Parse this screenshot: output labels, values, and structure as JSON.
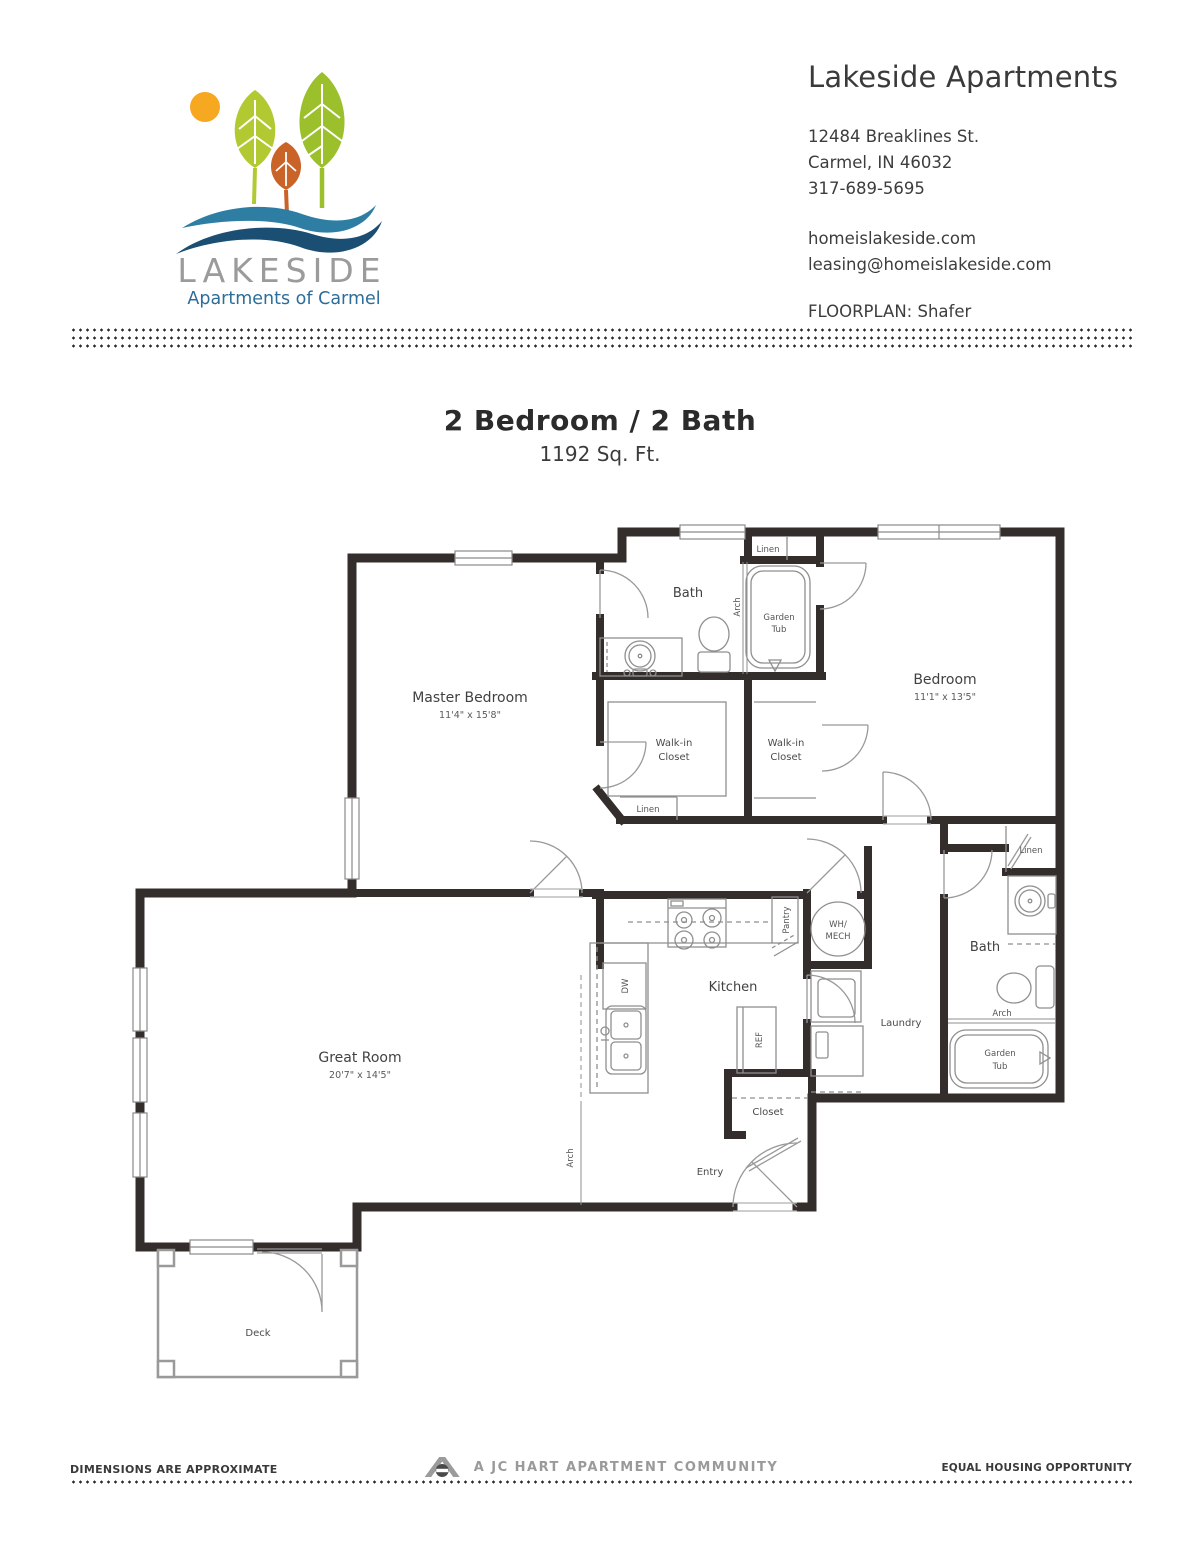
{
  "header": {
    "logo": {
      "wordmark": "LAKESIDE",
      "tagline": "Apartments of Carmel",
      "colors": {
        "sun": "#F6A821",
        "leaf_left": "#B3C931",
        "leaf_right": "#9CC02C",
        "leaf_orange": "#C96327",
        "wave_light": "#2E7EA4",
        "wave_dark": "#1A4E73",
        "wordmark": "#9B9B9B",
        "tagline": "#2C6E99"
      }
    },
    "title": "Lakeside Apartments",
    "address_line1": "12484 Breaklines St.",
    "address_line2": "Carmel, IN 46032",
    "phone": "317-689-5695",
    "website": "homeislakeside.com",
    "email": "leasing@homeislakeside.com",
    "floorplan_label": "FLOORPLAN:",
    "floorplan_value": "Shafer"
  },
  "plan_title": {
    "heading": "2 Bedroom / 2 Bath",
    "area": "1192 Sq. Ft."
  },
  "floorplan": {
    "colors": {
      "wall": "#332D2B",
      "fixture": "#8F8F8F",
      "thin": "#9A9A9A"
    },
    "rooms": {
      "master_bedroom": {
        "name": "Master Bedroom",
        "dims": "11'4\" x 15'8\""
      },
      "bedroom": {
        "name": "Bedroom",
        "dims": "11'1\" x 13'5\""
      },
      "great_room": {
        "name": "Great Room",
        "dims": "20'7\" x 14'5\""
      },
      "kitchen": {
        "name": "Kitchen"
      },
      "bath_main": {
        "name": "Bath"
      },
      "bath_second": {
        "name": "Bath"
      },
      "laundry": {
        "name": "Laundry"
      },
      "entry": {
        "name": "Entry"
      },
      "deck": {
        "name": "Deck"
      },
      "closet": {
        "name": "Closet"
      },
      "walk_in_closet": {
        "line1": "Walk-in",
        "line2": "Closet"
      }
    },
    "labels": {
      "linen": "Linen",
      "arch": "Arch",
      "pantry": "Pantry",
      "garden_tub_line1": "Garden",
      "garden_tub_line2": "Tub",
      "wh_mech_line1": "WH/",
      "wh_mech_line2": "MECH",
      "dw": "DW",
      "ref": "REF"
    }
  },
  "footer": {
    "left": "DIMENSIONS ARE APPROXIMATE",
    "center": "A JC HART APARTMENT COMMUNITY",
    "right": "EQUAL HOUSING OPPORTUNITY"
  }
}
